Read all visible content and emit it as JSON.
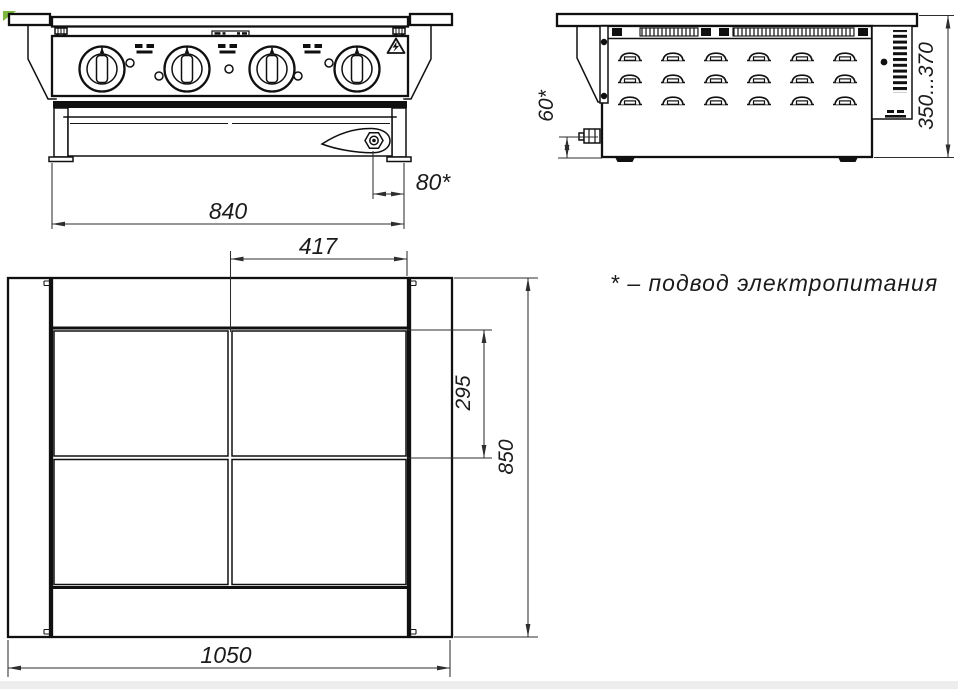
{
  "meta": {
    "background": "#ffffff",
    "line_color": "#101010",
    "dim_color": "#2e2e2e",
    "watermark_green": "#7cb93e"
  },
  "dimensions": {
    "front_width": "840",
    "gland_offset": "80*",
    "gland_height": "60*",
    "height_range": "350...370",
    "zone_width": "417",
    "zone_depth": "295",
    "overall_depth": "850",
    "overall_width": "1050"
  },
  "note": {
    "text": "* – подвод электропитания"
  },
  "views": {
    "front": {
      "knobs": 4,
      "indicator_lights": 5,
      "hotplate_icons": 3
    },
    "side": {
      "louver_columns": 6,
      "louver_rows": 3
    },
    "plan": {
      "cooking_zones": 4
    }
  }
}
